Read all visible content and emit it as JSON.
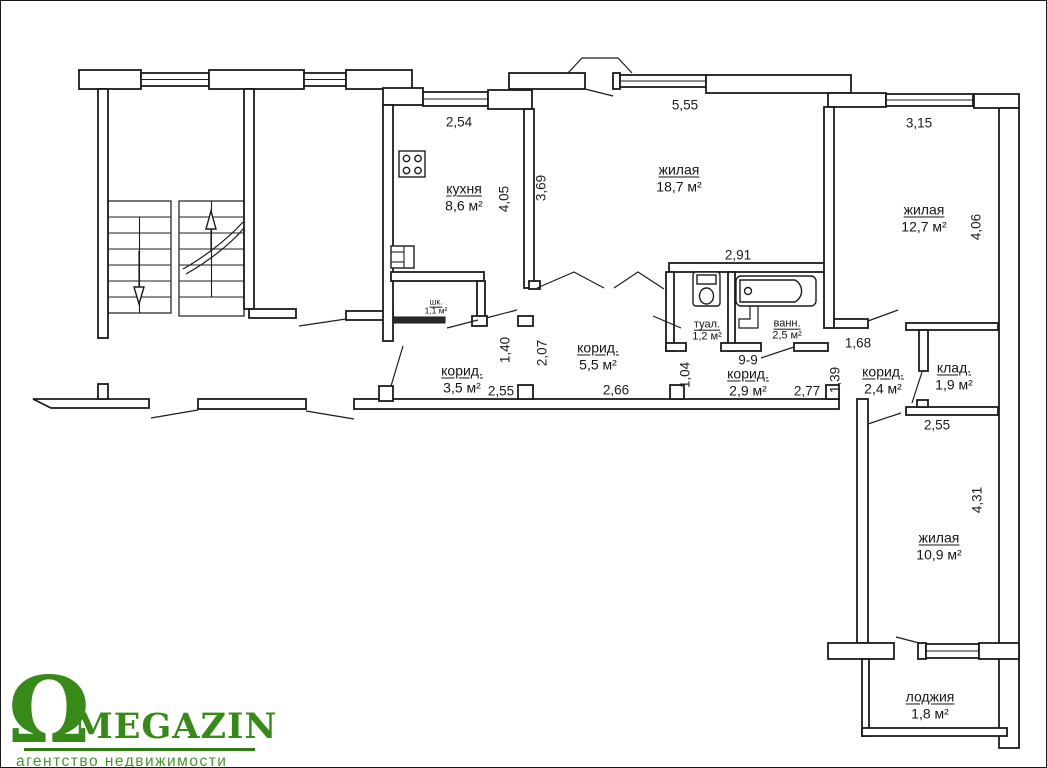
{
  "rooms": {
    "kitchen": {
      "label": "кухня",
      "area": "8,6 м²"
    },
    "living_18_7": {
      "label": "жилая",
      "area": "18,7 м²"
    },
    "living_12_7": {
      "label": "жилая",
      "area": "12,7 м²"
    },
    "living_10_9": {
      "label": "жилая",
      "area": "10,9 м²"
    },
    "corridor_3_5": {
      "label": "корид.",
      "area": "3,5 м²"
    },
    "corridor_5_5": {
      "label": "корид.",
      "area": "5,5 м²"
    },
    "corridor_2_9": {
      "label": "корид.",
      "area": "2,9 м²"
    },
    "corridor_2_4": {
      "label": "корид.",
      "area": "2,4 м²"
    },
    "toilet": {
      "label": "туал.",
      "area": "1,2 м²"
    },
    "bath": {
      "label": "ванн.",
      "area": "2,5 м²"
    },
    "storage": {
      "label": "клад.",
      "area": "1,9 м²"
    },
    "closet": {
      "label": "шк.",
      "area": "1,1 м²"
    },
    "loggia": {
      "label": "лоджия",
      "area": "1,8 м²"
    }
  },
  "dims": {
    "kitchen_width": "2,54",
    "living_18_7_width": "5,55",
    "living_12_7_width": "3,15",
    "kitchen_height": "4,05",
    "living_18_7_height": "3,69",
    "living_12_7_height": "4,06",
    "san_width": "2,91",
    "closet_height": "1,40",
    "corridor_5_5_height": "2,07",
    "passage_height": "1,04",
    "opening_1_68": "1,68",
    "opening_1_39": "1,39",
    "corridor_3_5_width": "2,55",
    "corridor_5_5_width": "2,66",
    "corridor_2_9_width": "2,77",
    "storage_width": "2,55",
    "living_10_9_height": "4,31",
    "section_mark": "9-9"
  },
  "logo": {
    "symbol": "Ω",
    "name": "MEGAZIN",
    "tagline": "агентство недвижимости",
    "color": "#378a17"
  }
}
